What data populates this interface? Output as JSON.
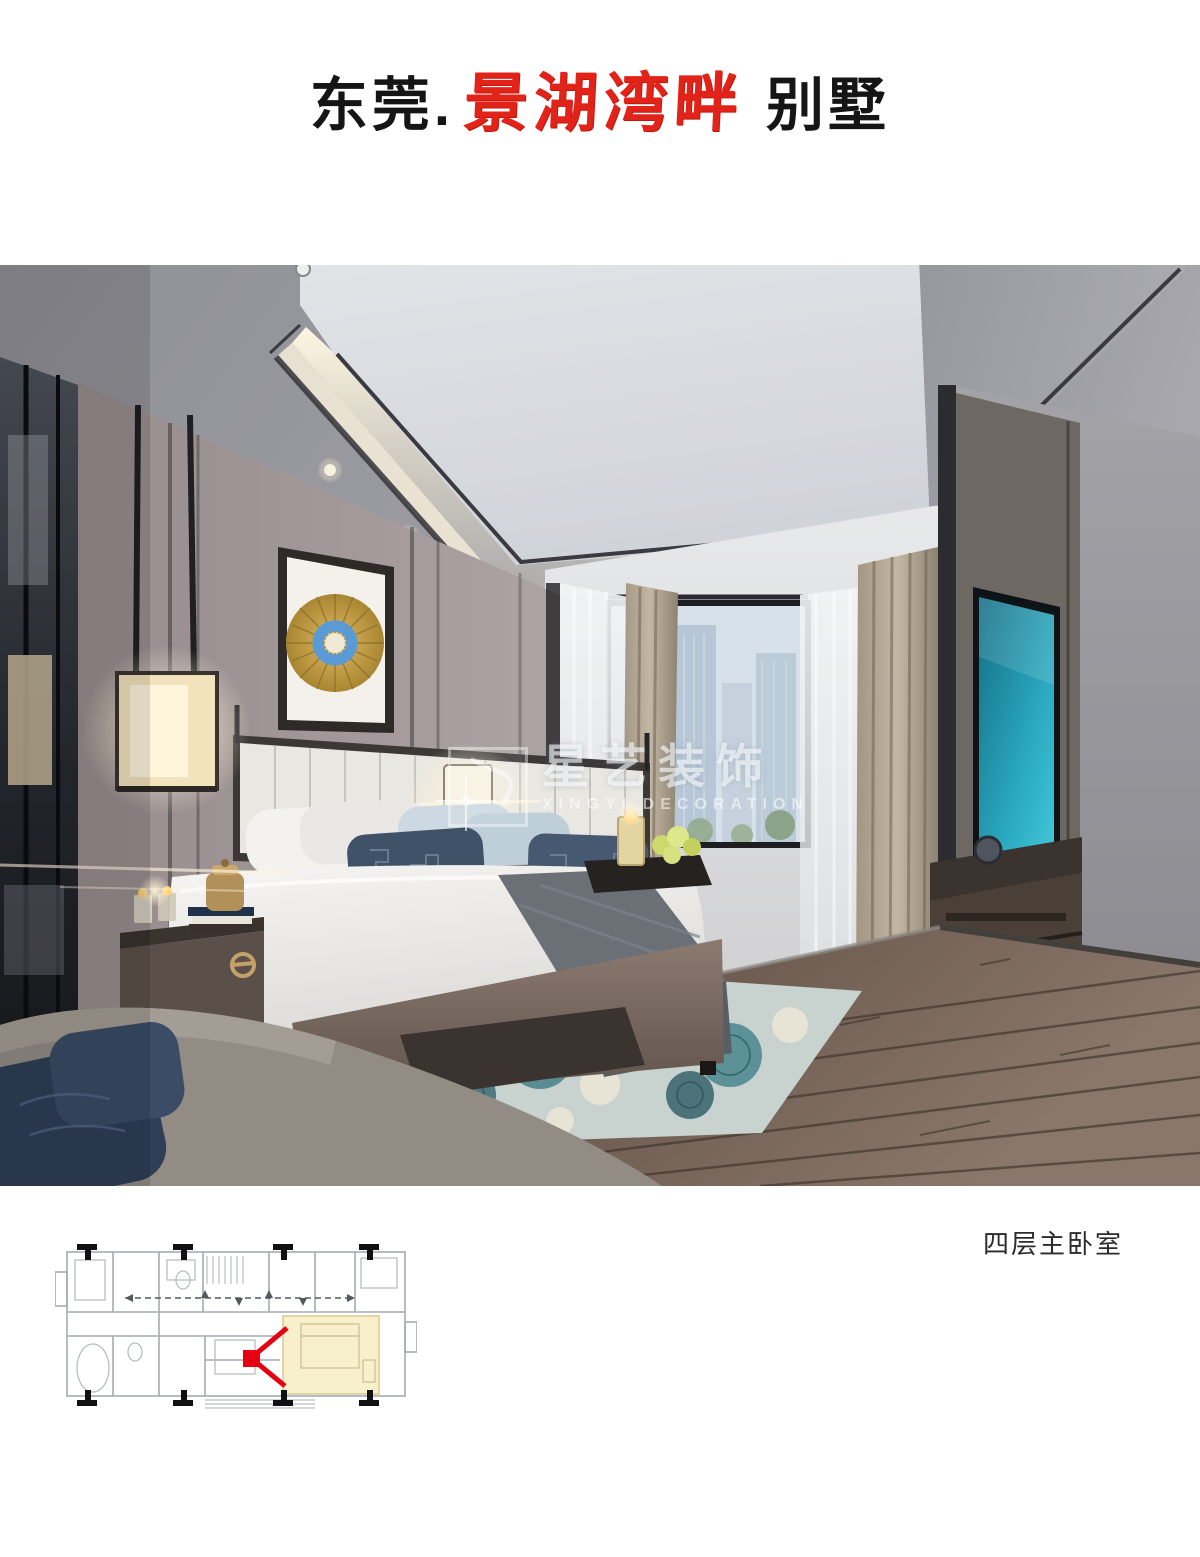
{
  "header": {
    "title_prefix": "东莞.",
    "title_project": "景湖湾畔",
    "title_suffix": "别墅"
  },
  "watermark": {
    "cn": "星艺装饰",
    "en": "XINGYI DECORATION"
  },
  "render": {
    "caption": "四层主卧室"
  },
  "colors": {
    "title_black": "#151515",
    "title_red": "#e2231a",
    "watermark_white": "rgba(255,255,255,0.6)",
    "plan_highlight": "#f7f0cb",
    "plan_arrow_red": "#e60012",
    "tv_screen_teal": "#2aa9c0",
    "art_gold": "#c8a34e",
    "art_blue": "#5b9bd5"
  }
}
